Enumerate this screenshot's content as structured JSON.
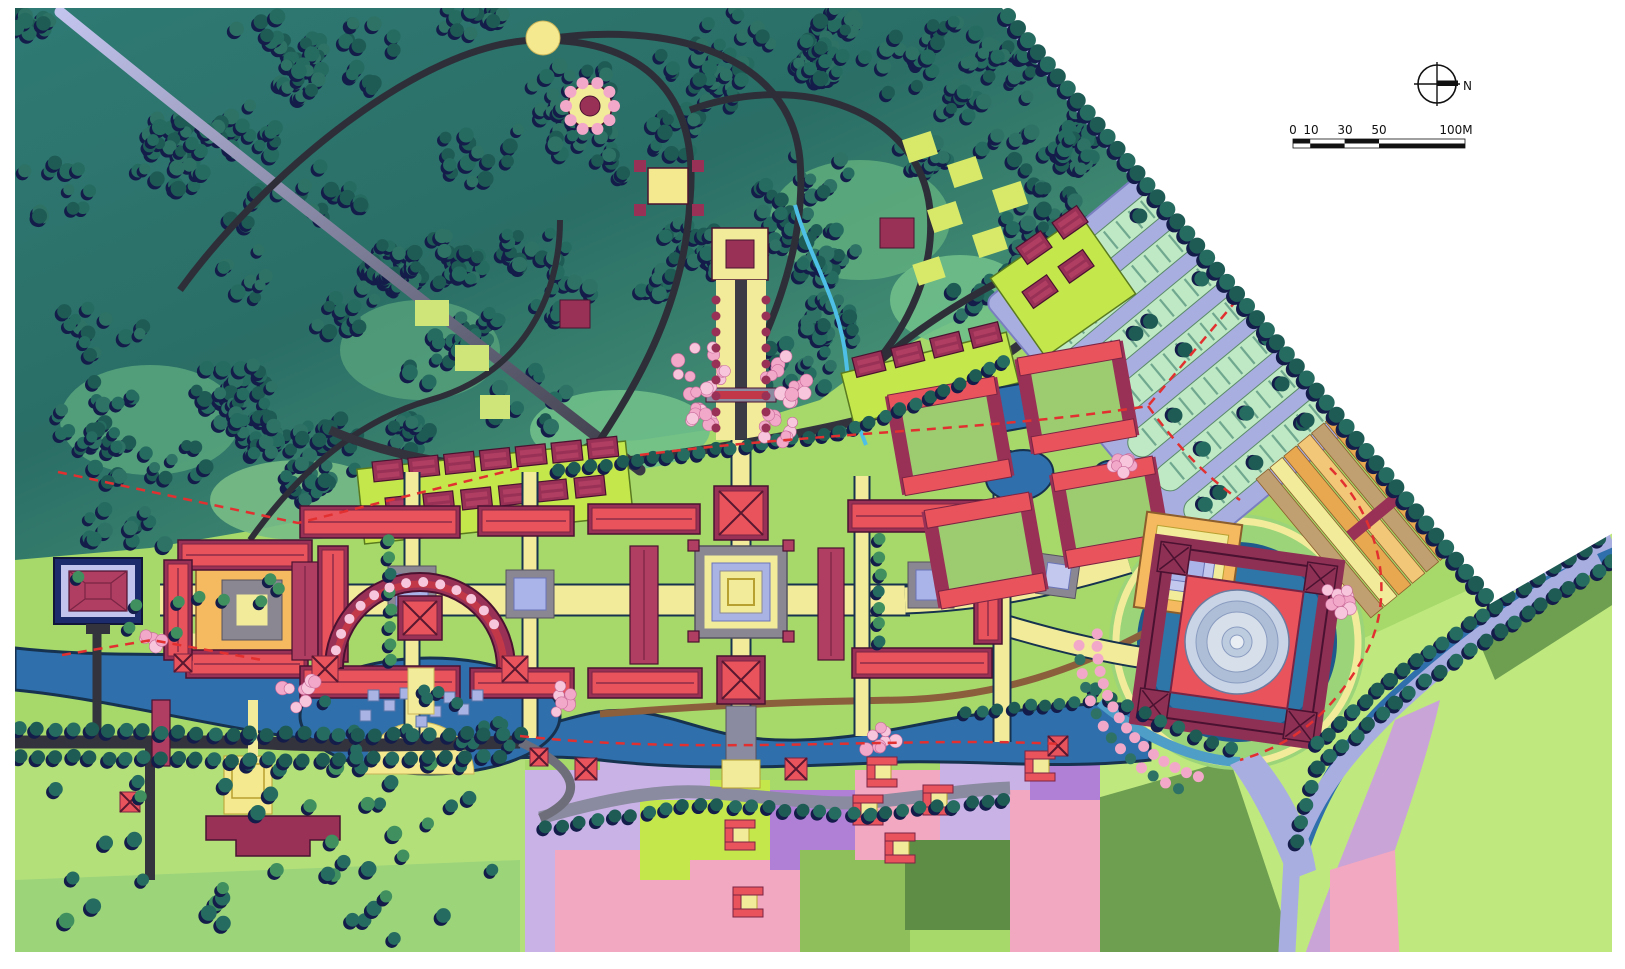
{
  "compass": {
    "label": "N"
  },
  "scale_bar": {
    "labels": [
      "0",
      "10",
      "30",
      "50",
      "100M"
    ]
  },
  "palette": {
    "paper": "#ffffff",
    "forest_dark": "#1e5b55",
    "forest_mid": "#266b60",
    "forest_light": "#2e7265",
    "tree_shadow": "#141c4a",
    "forest_bg1": "#2a6e66",
    "forest_bg2": "#56a77f",
    "meadow": "#5fae7e",
    "lawn": "#a6d96a",
    "lawn_pale": "#bfe97f",
    "lime": "#c4e84c",
    "water_deep": "#2e6fac",
    "water_dark_edge": "#16324f",
    "water_light": "#9fd0e8",
    "road_dark": "#33333d",
    "road_gray": "#8a8aa0",
    "road_lavender": "#a9aee0",
    "road_lavender_light": "#c3c4ee",
    "path_yellow": "#f2ec9a",
    "court_orange": "#f5b960",
    "roof_red": "#e8535c",
    "roof_red_dark": "#c23848",
    "roof_maroon": "#993156",
    "tree_pink": "#f2a8c8",
    "tree_pink_light": "#f7c6dc",
    "field_pink": "#f2a8c0",
    "field_lavender": "#c9b2e6",
    "field_purple": "#b07fd6",
    "field_olive": "#6e9e50",
    "field_green": "#8fbf5a",
    "band_mauve": "#c9a4d6",
    "stall_green": "#bfe8c4",
    "dome_silver1": "#c9d4e6",
    "dome_silver2": "#aebed6",
    "dome_silver3": "#e8eef4",
    "dash_red": "#e23030",
    "ink": "#111111",
    "brown_road": "#8b5e3c",
    "terrace_orange": "#e8a850",
    "terrace_peach": "#f2c878",
    "terrace_tan": "#c0a070"
  }
}
